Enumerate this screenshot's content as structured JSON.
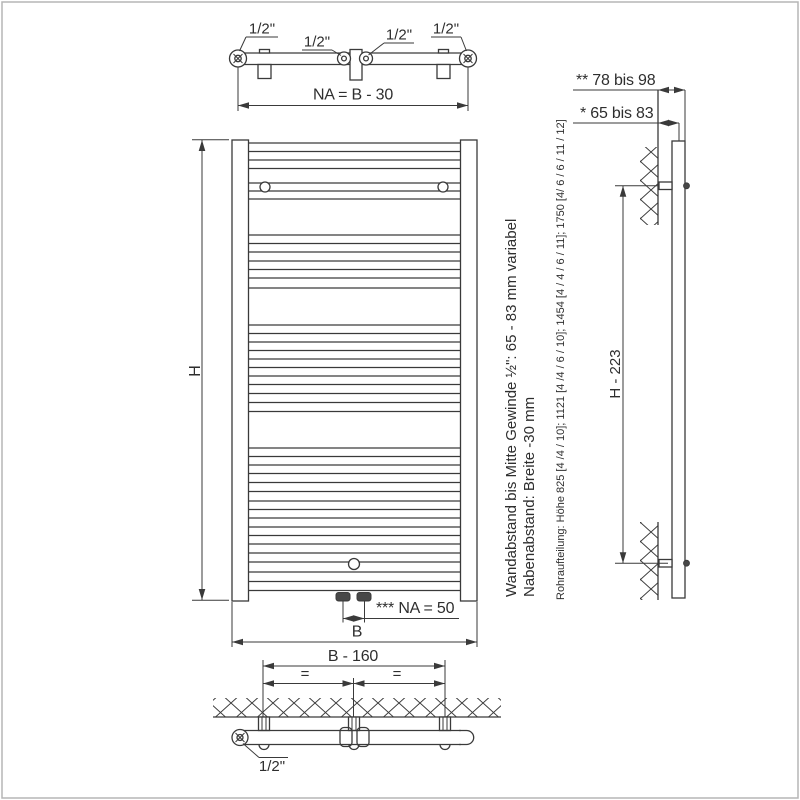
{
  "top_view": {
    "connection_labels": [
      "1/2\"",
      "1/2\"",
      "1/2\"",
      "1/2\""
    ],
    "hub_distance_dim": "NA = B - 30"
  },
  "front_view": {
    "height_label": "H",
    "width_label": "B",
    "bottom_hub_dim": "*** NA = 50",
    "tube_rows": [
      143,
      151.5,
      160,
      168.5,
      183,
      191,
      199,
      235,
      243.5,
      252,
      261,
      269.5,
      278,
      288,
      325,
      333.5,
      342,
      350.5,
      359,
      367.5,
      376,
      384.5,
      393.5,
      402.5,
      411.5,
      448,
      456.5,
      465,
      473.5,
      482.5,
      491.5,
      501,
      509.5,
      518,
      527,
      535.5,
      544,
      553,
      562,
      572,
      581.5,
      590.5
    ]
  },
  "side_view": {
    "wall_to_face_dim": "** 78 bis 98",
    "wall_to_center_dim": "* 65 bis 83",
    "bracket_spacing_dim": "H - 223"
  },
  "bottom_view": {
    "bracket_span_dim": "B - 160",
    "equal_left": "=",
    "equal_right": "=",
    "connection_label": "1/2\""
  },
  "notes": {
    "wall_distance_note": "Wandabstand bis Mitte Gewinde ½\": 65 - 83 mm variabel",
    "hub_distance_note": "Nabenabstand: Breite -30 mm",
    "pipe_layout_note": "Rohraufteilung: Höhe 825 [4 /4 / 10]; 1121 [4 /4 / 6 / 10]; 1454 [4 / 4 / 6 / 11]; 1750 [4/ 6 / 6 / 11 / 12]"
  },
  "colors": {
    "line": "#3a3a3a",
    "text": "#2e2e2e",
    "background": "#ffffff",
    "border": "#b5b5b5",
    "connector_fill": "#474747"
  }
}
